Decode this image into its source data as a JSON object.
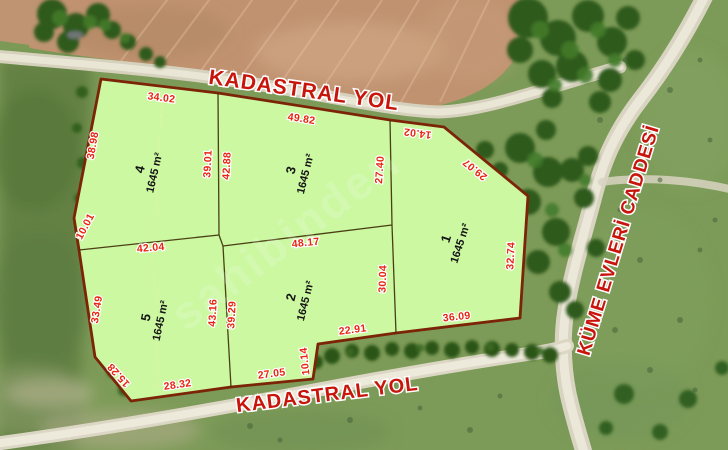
{
  "map": {
    "watermark": {
      "text": "sahibinden"
    },
    "roads": {
      "top_label": "KADASTRAL YOL",
      "bottom_label": "KADASTRAL YOL",
      "right_label": "KÜME EVLERİ CADDESİ"
    },
    "parcels": {
      "p1": {
        "number": "1",
        "area": "1645 m²"
      },
      "p2": {
        "number": "2",
        "area": "1645 m²"
      },
      "p3": {
        "number": "3",
        "area": "1645 m²"
      },
      "p4": {
        "number": "4",
        "area": "1645 m²"
      },
      "p5": {
        "number": "5",
        "area": "1645 m²"
      }
    },
    "dimensions": {
      "p4_top": "34.02",
      "p3_top": "49.82",
      "p1_top": "14.02",
      "p1_diag": "29.07",
      "p3_right": "27.40",
      "p1_right": "32.74",
      "p1_bottom": "36.09",
      "p2_right": "30.04",
      "p2_bottom_right": "22.91",
      "p2_step": "10.14",
      "p2_bottom": "27.05",
      "p5_bottom": "28.32",
      "p5_diag": "15.28",
      "p5_left": "33.49",
      "p45_left": "10.01",
      "p4_left": "38.98",
      "p5_top": "42.04",
      "p2_top": "48.17",
      "p4_right": "39.01",
      "p3_left": "42.88",
      "p5_right": "43.16",
      "p2_left": "39.29"
    },
    "colors": {
      "parcel_fill": "#cbf8a1",
      "parcel_border": "#7b2407",
      "divider_line": "#3d2b05",
      "dimension_text": "#e8240f",
      "road_label_text": "#c8150c",
      "parcel_label_text": "#141414",
      "field": "#c09270",
      "grass": "#7d9b58",
      "trees": "#2f5a1d",
      "road": "#ded9c6"
    }
  }
}
